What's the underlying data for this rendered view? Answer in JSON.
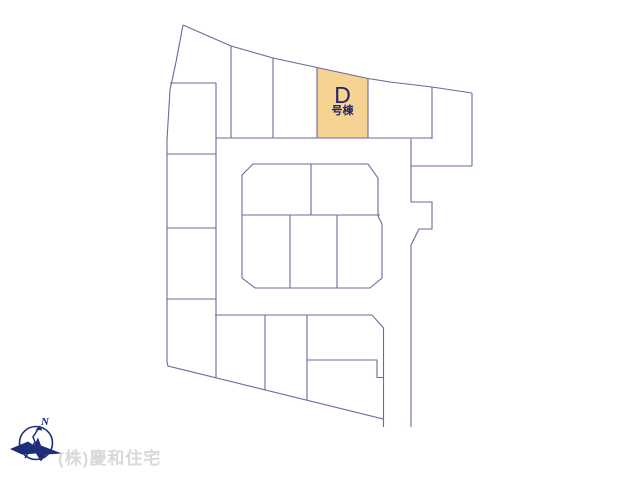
{
  "page": {
    "background_color": "#ffffff",
    "type": "real-estate-site-plan"
  },
  "map": {
    "line_color": "#6a6a9e",
    "highlighted_plot": {
      "label": "D",
      "sublabel": "号棟",
      "fill_color": "#f6d392",
      "text_color": "#232366"
    }
  },
  "compass": {
    "north_label": "N",
    "color": "#1c2d7a"
  },
  "footer": {
    "company_watermark": "(株)慶和住宅",
    "color": "#d9d9d9"
  }
}
